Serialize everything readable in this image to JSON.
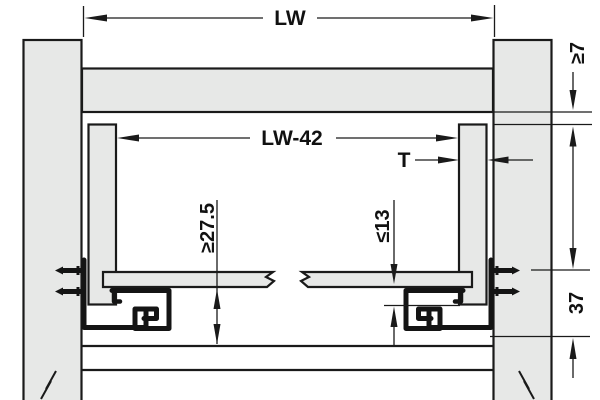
{
  "drawing": {
    "type": "technical-installation-drawing",
    "dimensions": {
      "lw": {
        "label": "LW"
      },
      "lw_minus_42": {
        "label": "LW-42"
      },
      "t": {
        "label": "T"
      },
      "min_7": {
        "label": "≥7"
      },
      "max_13": {
        "label": "≤13"
      },
      "min_27_5": {
        "label": "≥27.5"
      },
      "h_37": {
        "label": "37"
      }
    },
    "colors": {
      "panel_fill": "#e7e8e7",
      "outline": "#1a1a1a",
      "background": "#ffffff"
    }
  }
}
